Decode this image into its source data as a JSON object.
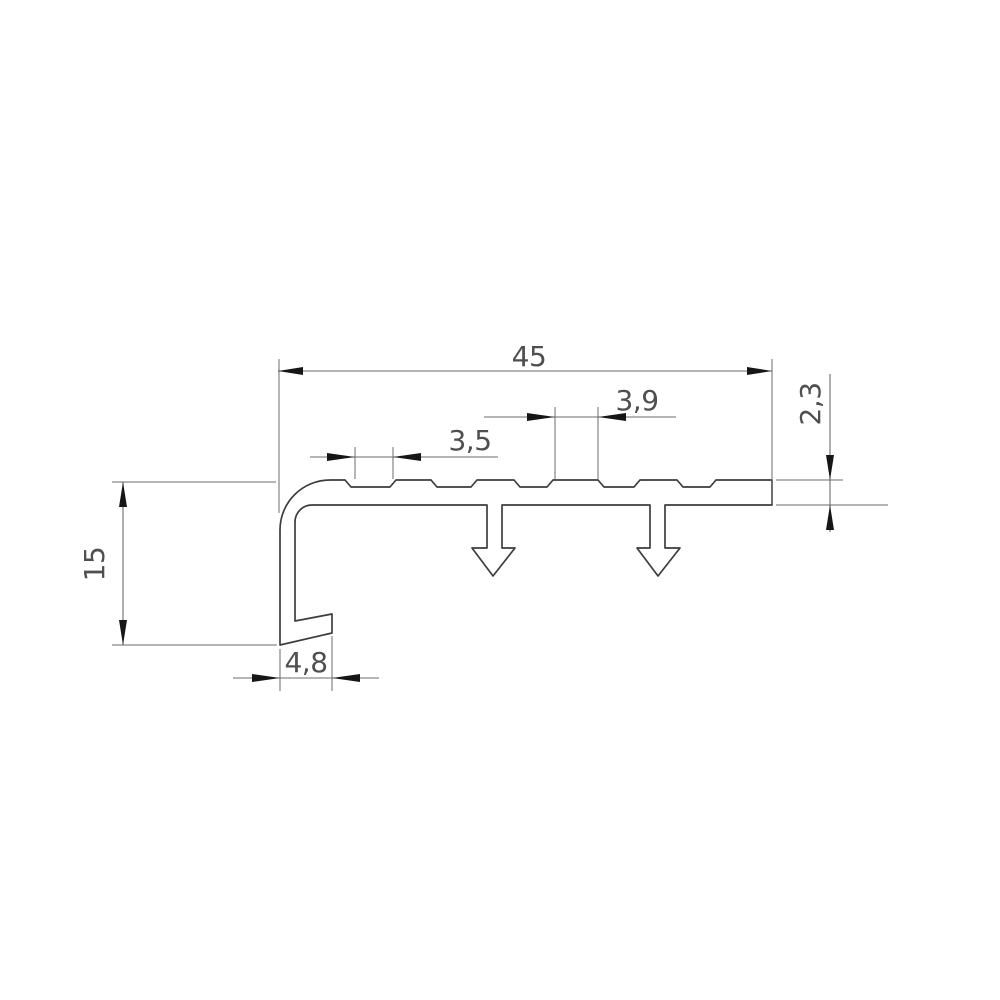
{
  "drawing": {
    "kind": "technical-cross-section-profile",
    "dimensions": {
      "total_width": "45",
      "bar_thickness": "2,3",
      "rib_width": "3,9",
      "groove_width": "3,5",
      "leg_height": "15",
      "foot_width": "4,8"
    },
    "colors": {
      "background": "#ffffff",
      "profile_line": "#3d3d3d",
      "dimension_line": "#6b6b6b",
      "arrowhead": "#161616",
      "text": "#4f4f4f"
    }
  }
}
